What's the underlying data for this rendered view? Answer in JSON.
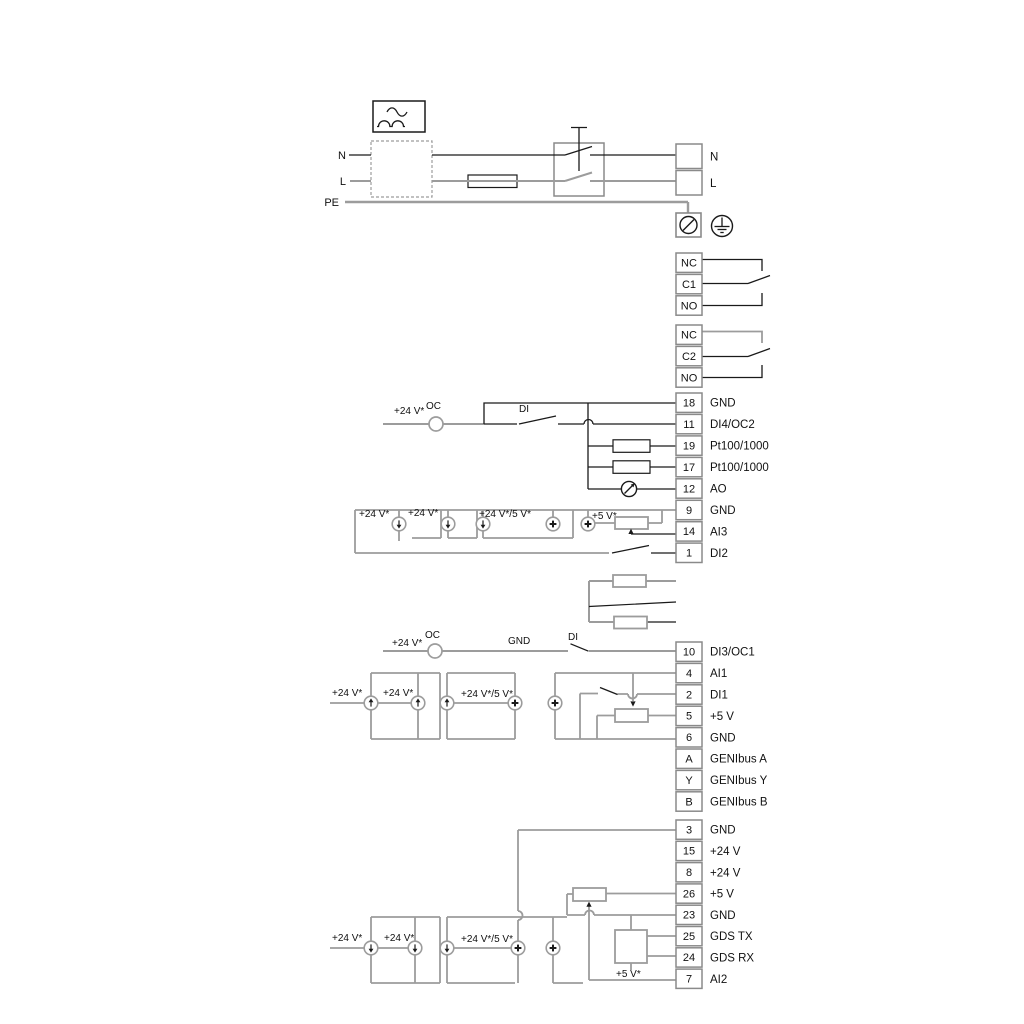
{
  "diagram": {
    "title": "pump wiring diagram",
    "wire_colors": {
      "gray": "#9c9c9c",
      "black": "#1a1a1a"
    },
    "terminal_blocks": [
      {
        "name": "mains-terminal-block",
        "x": 676,
        "y": 143,
        "w": 26,
        "row_h": 26.5,
        "cells": [
          {
            "id": "",
            "label": "N"
          },
          {
            "id": "",
            "label": "L"
          }
        ]
      },
      {
        "name": "relay-1-block",
        "x": 676,
        "y": 252,
        "w": 26,
        "row_h": 21.4,
        "cells": [
          {
            "id": "NC",
            "label": ""
          },
          {
            "id": "C1",
            "label": ""
          },
          {
            "id": "NO",
            "label": ""
          }
        ]
      },
      {
        "name": "relay-2-block",
        "x": 676,
        "y": 324,
        "w": 26,
        "row_h": 21.4,
        "cells": [
          {
            "id": "NC",
            "label": ""
          },
          {
            "id": "C2",
            "label": ""
          },
          {
            "id": "NO",
            "label": ""
          }
        ]
      },
      {
        "name": "io-terminal-block-1",
        "x": 676,
        "y": 392,
        "w": 26,
        "row_h": 21.45,
        "cells": [
          {
            "id": "18",
            "label": "GND"
          },
          {
            "id": "11",
            "label": "DI4/OC2"
          },
          {
            "id": "19",
            "label": "Pt100/1000"
          },
          {
            "id": "17",
            "label": "Pt100/1000"
          },
          {
            "id": "12",
            "label": "AO"
          },
          {
            "id": "9",
            "label": "GND"
          },
          {
            "id": "14",
            "label": "AI3"
          },
          {
            "id": "1",
            "label": "DI2"
          }
        ]
      },
      {
        "name": "io-terminal-block-2",
        "x": 676,
        "y": 641,
        "w": 26,
        "row_h": 21.4,
        "cells": [
          {
            "id": "10",
            "label": "DI3/OC1"
          },
          {
            "id": "4",
            "label": "AI1"
          },
          {
            "id": "2",
            "label": "DI1"
          },
          {
            "id": "5",
            "label": "+5 V"
          },
          {
            "id": "6",
            "label": "GND"
          },
          {
            "id": "A",
            "label": "GENIbus A"
          },
          {
            "id": "Y",
            "label": "GENIbus Y"
          },
          {
            "id": "B",
            "label": "GENIbus B"
          }
        ]
      },
      {
        "name": "io-terminal-block-3",
        "x": 676,
        "y": 819,
        "w": 26,
        "row_h": 21.3,
        "cells": [
          {
            "id": "3",
            "label": "GND"
          },
          {
            "id": "15",
            "label": "+24 V"
          },
          {
            "id": "8",
            "label": "+24 V"
          },
          {
            "id": "26",
            "label": "+5 V"
          },
          {
            "id": "23",
            "label": "GND"
          },
          {
            "id": "25",
            "label": "GDS TX"
          },
          {
            "id": "24",
            "label": "GDS RX"
          },
          {
            "id": "7",
            "label": "AI2"
          }
        ]
      }
    ],
    "labels": [
      {
        "text": "N",
        "x": 346,
        "y": 159,
        "anchor": "end",
        "size": 11,
        "name": "mains-n-label"
      },
      {
        "text": "L",
        "x": 346,
        "y": 185,
        "anchor": "end",
        "size": 11,
        "name": "mains-l-label"
      },
      {
        "text": "PE",
        "x": 339,
        "y": 206,
        "anchor": "end",
        "size": 11,
        "name": "mains-pe-label"
      },
      {
        "text": "+24 V*",
        "x": 394,
        "y": 414,
        "name": "supply-label"
      },
      {
        "text": "OC",
        "x": 426,
        "y": 409,
        "name": "open-collector-label"
      },
      {
        "text": "DI",
        "x": 519,
        "y": 412,
        "name": "digital-input-label"
      },
      {
        "text": "+24 V*",
        "x": 359,
        "y": 517,
        "name": "supply-label"
      },
      {
        "text": "+24 V*",
        "x": 408,
        "y": 516,
        "name": "supply-label"
      },
      {
        "text": "+24 V*/5 V*",
        "x": 479,
        "y": 517,
        "name": "supply-label"
      },
      {
        "text": "+5 V*",
        "x": 592,
        "y": 519,
        "name": "supply-label"
      },
      {
        "text": "+24 V*",
        "x": 392,
        "y": 646,
        "name": "supply-label"
      },
      {
        "text": "OC",
        "x": 425,
        "y": 638,
        "name": "open-collector-label"
      },
      {
        "text": "GND",
        "x": 508,
        "y": 644,
        "name": "gnd-label"
      },
      {
        "text": "DI",
        "x": 568,
        "y": 640,
        "name": "digital-input-label"
      },
      {
        "text": "+24 V*",
        "x": 332,
        "y": 696,
        "name": "supply-label"
      },
      {
        "text": "+24 V*",
        "x": 383,
        "y": 696,
        "name": "supply-label"
      },
      {
        "text": "+24 V*/5 V*",
        "x": 461,
        "y": 697,
        "name": "supply-label"
      },
      {
        "text": "+24 V*",
        "x": 332,
        "y": 941,
        "name": "supply-label"
      },
      {
        "text": "+24 V*",
        "x": 384,
        "y": 941,
        "name": "supply-label"
      },
      {
        "text": "+24 V*/5 V*",
        "x": 461,
        "y": 942,
        "name": "supply-label"
      },
      {
        "text": "+5 V*",
        "x": 616,
        "y": 977,
        "name": "gds-supply-label"
      }
    ]
  }
}
